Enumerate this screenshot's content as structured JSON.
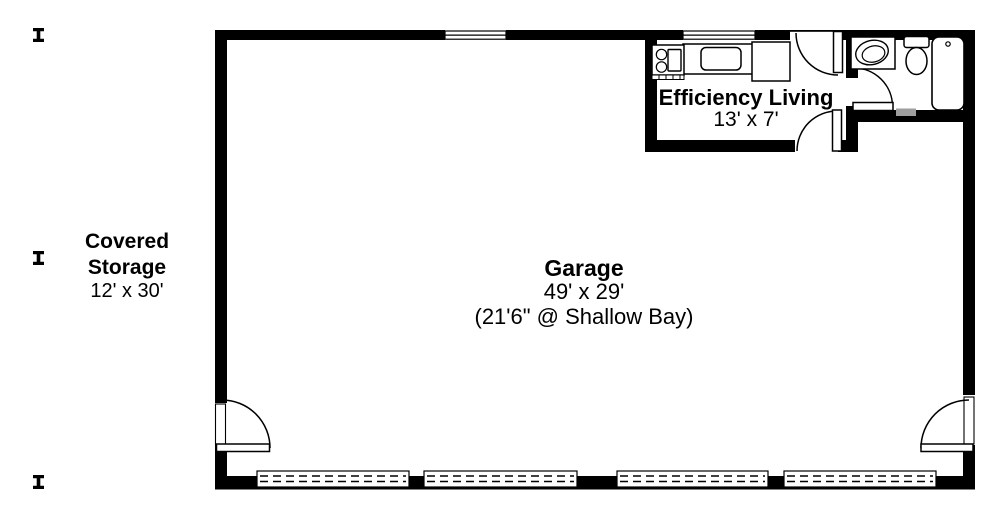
{
  "plan": {
    "rooms": {
      "garage": {
        "name": "Garage",
        "dimensions": "49' x 29'",
        "note": "(21'6\" @ Shallow Bay)"
      },
      "efficiency_living": {
        "name": "Efficiency Living",
        "dimensions": "13' x 7'"
      },
      "covered_storage": {
        "name": "Covered\nStorage",
        "dimensions": "12' x 30'"
      }
    },
    "colors": {
      "walls": "#000000",
      "background": "#ffffff",
      "threshold": "#9e9e9e"
    },
    "fixtures": [
      "range",
      "kitchen-sink",
      "refrigerator",
      "vanity-sink",
      "toilet",
      "bathtub",
      "garage-door-panel",
      "door-swing",
      "window",
      "post"
    ]
  }
}
